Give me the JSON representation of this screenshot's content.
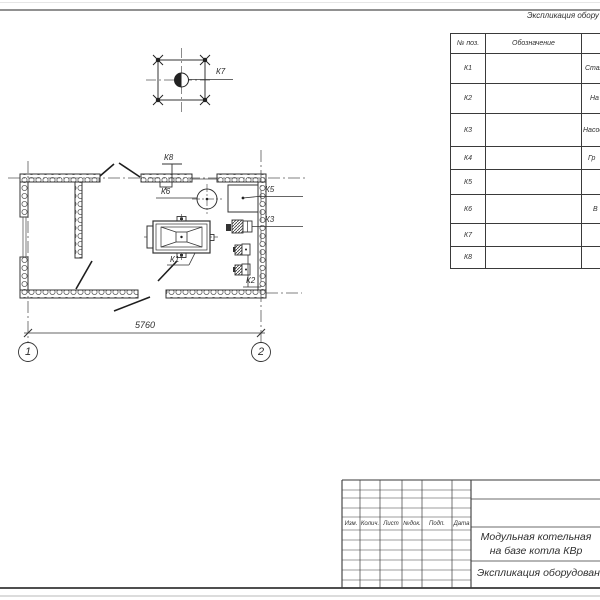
{
  "colors": {
    "line": "#3a3a3a",
    "hatch": "#5f5f5f",
    "page_edge": "#919191"
  },
  "equipment_table": {
    "title_fragment": "Экспликация обору",
    "col_pos_header": "№ поз.",
    "col_designation_header": "Обозначение",
    "rows": [
      {
        "pos": "К1",
        "designation": "",
        "name_fragment": "Стал"
      },
      {
        "pos": "К2",
        "designation": "",
        "name_fragment": "На"
      },
      {
        "pos": "К3",
        "designation": "",
        "name_fragment": "Насос"
      },
      {
        "pos": "К4",
        "designation": "",
        "name_fragment": "Гр"
      },
      {
        "pos": "К5",
        "designation": "",
        "name_fragment": ""
      },
      {
        "pos": "К6",
        "designation": "",
        "name_fragment": "В"
      },
      {
        "pos": "К7",
        "designation": "",
        "name_fragment": ""
      },
      {
        "pos": "К8",
        "designation": "",
        "name_fragment": ""
      }
    ]
  },
  "plan": {
    "equipment_labels": {
      "k1": "К1",
      "k2": "К2",
      "k3": "К3",
      "k5": "К5",
      "k6": "К6",
      "k7": "К7",
      "k8": "К8"
    },
    "dimension_width": "5760",
    "axis_1": "1",
    "axis_2": "2"
  },
  "title_block": {
    "revision_headers": [
      "Изм.",
      "Колич.",
      "Лист",
      "№док.",
      "Подп.",
      "Дата"
    ],
    "object_name_line1": "Модульная котельная",
    "object_name_line2": "на базе котла КВр",
    "sheet_name_fragment": "Экспликация оборудован"
  }
}
